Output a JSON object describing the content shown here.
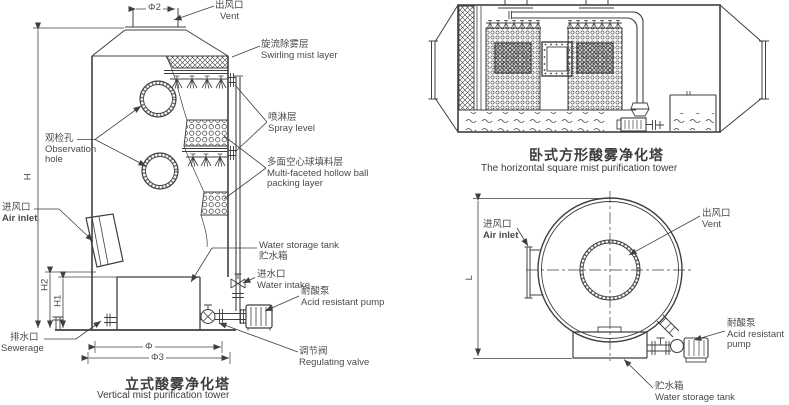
{
  "colors": {
    "line": "#3f3f3f",
    "text": "#4a4a4a"
  },
  "vertical_tower": {
    "title": {
      "zh": "立式酸雾净化塔",
      "en": "Vertical mist purification tower"
    },
    "labels": {
      "vent": {
        "zh": "出风口",
        "en": "Vent"
      },
      "swirl": {
        "zh": "旋流除雾层",
        "en": "Swirling mist layer"
      },
      "spray": {
        "zh": "喷淋层",
        "en": "Spray level"
      },
      "packing": {
        "zh": "多面空心球填料层",
        "en1": "Multi-faceted hollow ball",
        "en2": "packing layer"
      },
      "observation": {
        "zh": "观检孔",
        "en1": "Observation",
        "en2": "hole"
      },
      "air_inlet": {
        "zh": "进风口",
        "en": "Air inlet"
      },
      "sewerage": {
        "zh": "排水口",
        "en": "Sewerage"
      },
      "water_tank": {
        "en": "Water storage tank",
        "zh": "贮水箱"
      },
      "water_intake": {
        "zh": "进水口",
        "en": "Water intake"
      },
      "acid_pump": {
        "zh": "耐酸泵",
        "en": "Acid resistant pump"
      },
      "regulating_valve": {
        "zh": "调节阀",
        "en": "Regulating valve"
      }
    },
    "dimensions": {
      "top_diameter": "Φ2",
      "height": "H",
      "height1": "H1",
      "height2": "H2",
      "tank_width": "Φ",
      "base_width": "Φ3"
    }
  },
  "horizontal_tower": {
    "title": {
      "zh": "卧式方形酸雾净化塔",
      "en": "The horizontal square mist purification tower"
    }
  },
  "end_view": {
    "labels": {
      "air_inlet": {
        "zh": "进风口",
        "en": "Air inlet"
      },
      "vent": {
        "zh": "出风口",
        "en": "Vent"
      },
      "acid_pump": {
        "zh": "耐酸泵",
        "en1": "Acid resistant",
        "en2": "pump"
      },
      "water_tank": {
        "zh": "贮水箱",
        "en": "Water storage tank"
      }
    },
    "dimensions": {
      "length": "L"
    }
  }
}
